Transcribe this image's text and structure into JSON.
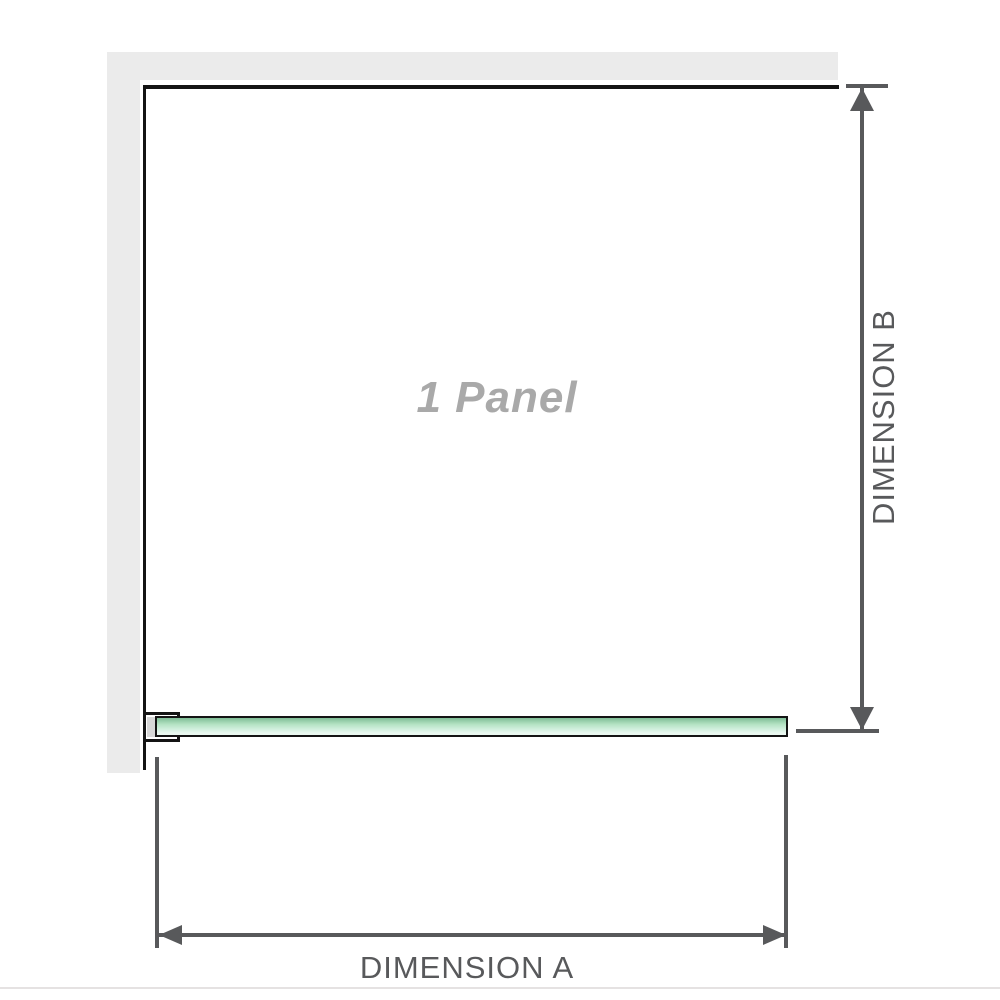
{
  "diagram": {
    "panel_label": "1 Panel",
    "dim_a_label": "DIMENSION A",
    "dim_b_label": "DIMENSION B"
  },
  "colors": {
    "wall": "#ebebeb",
    "outline": "#141414",
    "dim": "#58595b",
    "panel-label": "#a9a9a9",
    "glass-dark": "#7fbe97",
    "glass-mid": "#b5e3c4",
    "glass-light": "#eaf8f0",
    "bracket-block": "#d7d7d7",
    "baseline": "#e5e2e2"
  }
}
